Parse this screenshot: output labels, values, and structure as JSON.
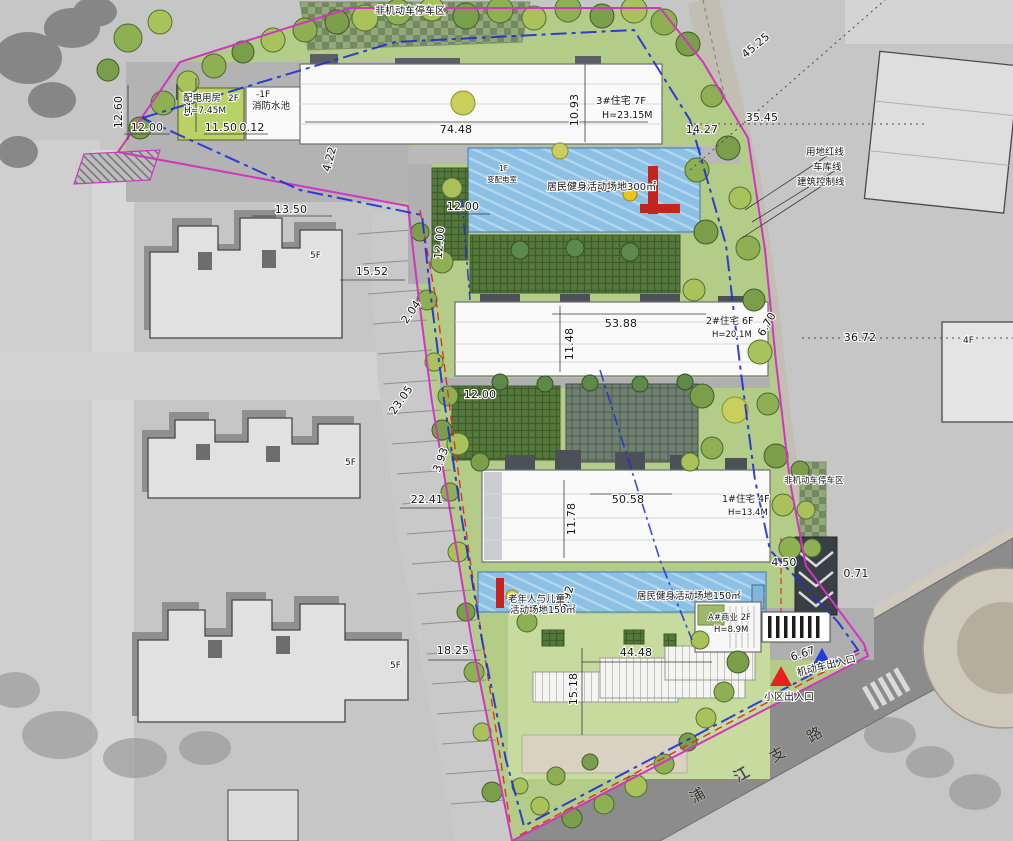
{
  "labels": {
    "bike_parking_top": "非机动车停车区",
    "power_room": "配电用房",
    "power_room_floor": "2F",
    "power_room_height": "H=7.45M",
    "fire_pool_floor": "-1F",
    "fire_pool": "消防水池",
    "transformer_floor": "1F",
    "transformer_room": "变配电室",
    "bldg3_name": "3#住宅 7F",
    "bldg3_height": "H=23.15M",
    "bldg2_name": "2#住宅 6F",
    "bldg2_height": "H=20.1M",
    "bldg1_name": "1#住宅 4F",
    "bldg1_height": "H=13.4M",
    "bldgA_name": "A#商业 2F",
    "bldgA_height": "H=8.9M",
    "fitness_area_300": "居民健身活动场地300㎡",
    "elderly_children_line1": "老年人与儿童",
    "elderly_children_line2": "活动场地150㎡",
    "fitness_area_150": "居民健身活动场地150㎡",
    "bike_parking_right": "非机动车停车区",
    "red_line": "用地红线",
    "garage_line": "车库线",
    "control_line": "建筑控制线",
    "entrance_community": "小区出入口",
    "entrance_vehicle": "机动车出入口",
    "existing_floors_5f": "5F",
    "existing_floors_4f": "4F"
  },
  "road_chars": [
    "浦",
    "江",
    "支",
    "路"
  ],
  "dimensions": [
    "12.60",
    "12.00",
    "9.48",
    "11.50",
    "0.12",
    "74.48",
    "10.93",
    "4.22",
    "45.25",
    "35.45",
    "14.27",
    "13.50",
    "15.52",
    "12.00",
    "12.00",
    "23.05",
    "3.93",
    "22.41",
    "11.48",
    "53.88",
    "6.70",
    "36.72",
    "12.00",
    "11.78",
    "50.58",
    "4.50",
    "0.71",
    "6.92",
    "18.25",
    "44.48",
    "15.18",
    "6.67",
    "2.04"
  ],
  "colors": {
    "property_line": "#d036c0",
    "building_control_line": "#e03028",
    "garage_line": "#1f2fd4",
    "entrance_marker_community": "#e8211d",
    "entrance_marker_vehicle": "#1f3de0",
    "activity_water": "#8cc0e4",
    "lawn": "#b3cc87"
  }
}
